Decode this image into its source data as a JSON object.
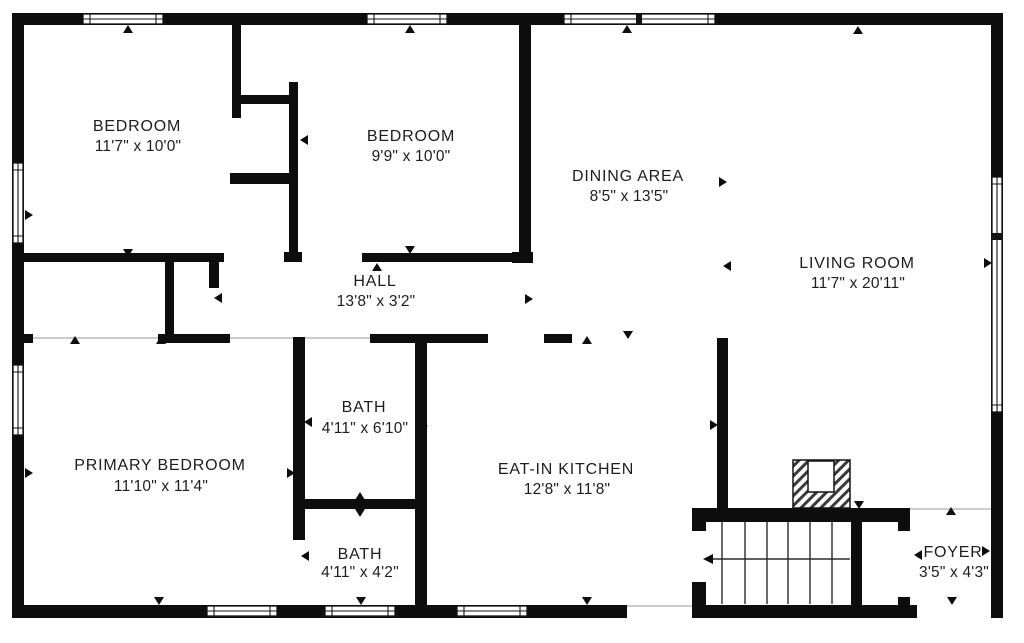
{
  "title": "Floor plan",
  "colors": {
    "wall": "#0d0d0d",
    "background": "#ffffff",
    "text": "#1d1d1d",
    "opening_line": "#adadad"
  },
  "rooms": [
    {
      "id": "bedroom-1",
      "name": "BEDROOM",
      "dims": "11'7\" x 10'0\""
    },
    {
      "id": "bedroom-2",
      "name": "BEDROOM",
      "dims": "9'9\" x 10'0\""
    },
    {
      "id": "dining-area",
      "name": "DINING AREA",
      "dims": "8'5\" x 13'5\""
    },
    {
      "id": "living-room",
      "name": "LIVING ROOM",
      "dims": "11'7\" x 20'11\""
    },
    {
      "id": "hall",
      "name": "HALL",
      "dims": "13'8\" x 3'2\""
    },
    {
      "id": "bath-upper",
      "name": "BATH",
      "dims": "4'11\" x 6'10\""
    },
    {
      "id": "primary-bedroom",
      "name": "PRIMARY BEDROOM",
      "dims": "11'10\" x 11'4\""
    },
    {
      "id": "eat-in-kitchen",
      "name": "EAT-IN KITCHEN",
      "dims": "12'8\" x 11'8\""
    },
    {
      "id": "bath-lower",
      "name": "BATH",
      "dims": "4'11\" x 4'2\""
    },
    {
      "id": "foyer",
      "name": "FOYER",
      "dims": "3'5\" x 4'3\""
    }
  ],
  "icons": {
    "door_marker": "small-triangle",
    "window": "double-line-window",
    "stairs_arrow": "left-arrow",
    "fireplace": "diagonal-hatch-block"
  }
}
